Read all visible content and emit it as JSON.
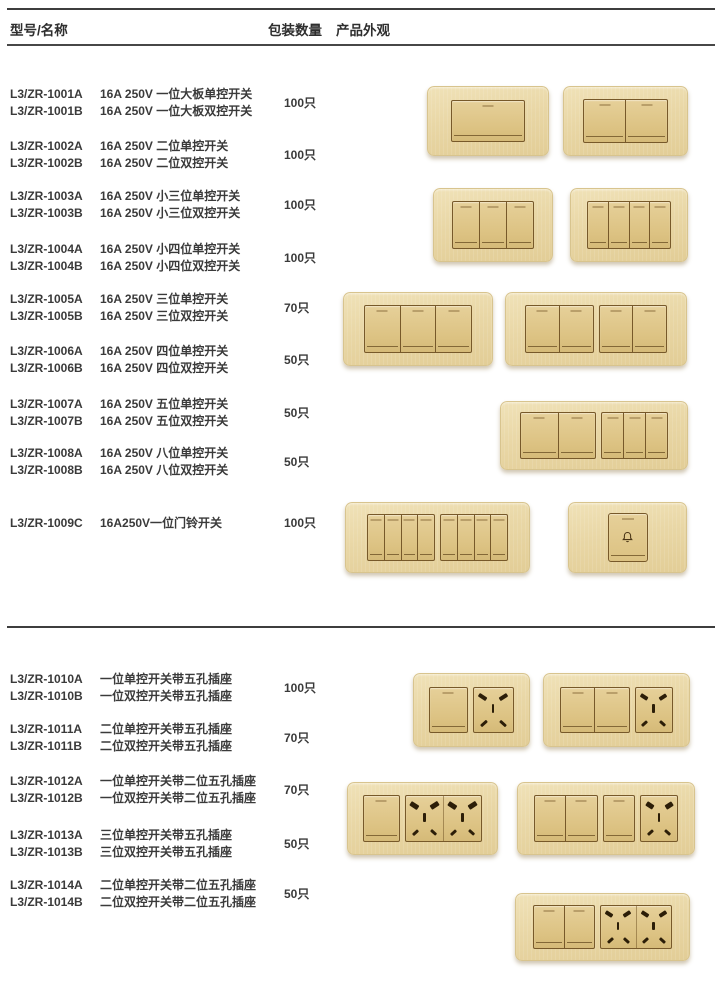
{
  "header": {
    "col_model": "型号/名称",
    "col_qty": "包装数量",
    "col_appearance": "产品外观"
  },
  "table": {
    "rows": [
      {
        "entries": [
          {
            "model": "L3/ZR-1001A",
            "desc": "16A 250V 一位大板单控开关"
          },
          {
            "model": "L3/ZR-1001B",
            "desc": "16A 250V 一位大板双控开关"
          }
        ],
        "qty": "100只"
      },
      {
        "entries": [
          {
            "model": "L3/ZR-1002A",
            "desc": "16A 250V 二位单控开关"
          },
          {
            "model": "L3/ZR-1002B",
            "desc": "16A 250V 二位双控开关"
          }
        ],
        "qty": "100只"
      },
      {
        "entries": [
          {
            "model": "L3/ZR-1003A",
            "desc": "16A 250V 小三位单控开关"
          },
          {
            "model": "L3/ZR-1003B",
            "desc": "16A 250V 小三位双控开关"
          }
        ],
        "qty": "100只"
      },
      {
        "entries": [
          {
            "model": "L3/ZR-1004A",
            "desc": "16A 250V 小四位单控开关"
          },
          {
            "model": "L3/ZR-1004B",
            "desc": "16A 250V 小四位双控开关"
          }
        ],
        "qty": "100只"
      },
      {
        "entries": [
          {
            "model": "L3/ZR-1005A",
            "desc": "16A 250V 三位单控开关"
          },
          {
            "model": "L3/ZR-1005B",
            "desc": "16A 250V 三位双控开关"
          }
        ],
        "qty": "70只"
      },
      {
        "entries": [
          {
            "model": "L3/ZR-1006A",
            "desc": "16A 250V 四位单控开关"
          },
          {
            "model": "L3/ZR-1006B",
            "desc": "16A 250V 四位双控开关"
          }
        ],
        "qty": "50只"
      },
      {
        "entries": [
          {
            "model": "L3/ZR-1007A",
            "desc": "16A 250V 五位单控开关"
          },
          {
            "model": "L3/ZR-1007B",
            "desc": "16A 250V 五位双控开关"
          }
        ],
        "qty": "50只"
      },
      {
        "entries": [
          {
            "model": "L3/ZR-1008A",
            "desc": "16A 250V 八位单控开关"
          },
          {
            "model": "L3/ZR-1008B",
            "desc": "16A 250V 八位双控开关"
          }
        ],
        "qty": "50只"
      },
      {
        "entries": [
          {
            "model": "L3/ZR-1009C",
            "desc": "16A250V一位门铃开关"
          }
        ],
        "qty": "100只"
      },
      {
        "entries": [
          {
            "model": "L3/ZR-1010A",
            "desc": "一位单控开关带五孔插座"
          },
          {
            "model": "L3/ZR-1010B",
            "desc": "一位双控开关带五孔插座"
          }
        ],
        "qty": "100只"
      },
      {
        "entries": [
          {
            "model": "L3/ZR-1011A",
            "desc": "二位单控开关带五孔插座"
          },
          {
            "model": "L3/ZR-1011B",
            "desc": "二位双控开关带五孔插座"
          }
        ],
        "qty": "70只"
      },
      {
        "entries": [
          {
            "model": "L3/ZR-1012A",
            "desc": "一位单控开关带二位五孔插座"
          },
          {
            "model": "L3/ZR-1012B",
            "desc": "一位双控开关带二位五孔插座"
          }
        ],
        "qty": "70只"
      },
      {
        "entries": [
          {
            "model": "L3/ZR-1013A",
            "desc": "三位单控开关带五孔插座"
          },
          {
            "model": "L3/ZR-1013B",
            "desc": "三位双控开关带五孔插座"
          }
        ],
        "qty": "50只"
      },
      {
        "entries": [
          {
            "model": "L3/ZR-1014A",
            "desc": "二位单控开关带二位五孔插座"
          },
          {
            "model": "L3/ZR-1014B",
            "desc": "二位双控开关带二位五孔插座"
          }
        ],
        "qty": "50只"
      }
    ]
  },
  "plates": [
    {
      "id": "1001",
      "label": "one-gang-large-switch",
      "modules": [
        {
          "kind": "rockers",
          "n": 1
        }
      ]
    },
    {
      "id": "1002",
      "label": "two-gang-switch",
      "modules": [
        {
          "kind": "rockers",
          "n": 2
        }
      ]
    },
    {
      "id": "1003",
      "label": "small-three-gang-switch",
      "modules": [
        {
          "kind": "rockers",
          "n": 3
        }
      ]
    },
    {
      "id": "1004",
      "label": "small-four-gang-switch",
      "modules": [
        {
          "kind": "rockers",
          "n": 4
        }
      ]
    },
    {
      "id": "1005",
      "label": "three-gang-switch-wide",
      "modules": [
        {
          "kind": "rockers",
          "n": 3
        }
      ]
    },
    {
      "id": "1006",
      "label": "four-gang-switch-wide",
      "modules": [
        {
          "kind": "rockers",
          "n": 2
        },
        {
          "kind": "rockers",
          "n": 2
        }
      ]
    },
    {
      "id": "1007",
      "label": "five-gang-switch",
      "modules": [
        {
          "kind": "rockers",
          "n": 2
        },
        {
          "kind": "rockers",
          "n": 3
        }
      ]
    },
    {
      "id": "1008",
      "label": "eight-gang-switch",
      "modules": [
        {
          "kind": "rockers",
          "n": 4
        },
        {
          "kind": "rockers",
          "n": 4
        }
      ]
    },
    {
      "id": "1009",
      "label": "doorbell-switch",
      "modules": [
        {
          "kind": "doorbell"
        }
      ]
    },
    {
      "id": "1010",
      "label": "one-switch-with-5hole-socket",
      "modules": [
        {
          "kind": "rockers",
          "n": 1
        },
        {
          "kind": "socket"
        }
      ]
    },
    {
      "id": "1011",
      "label": "two-switch-with-5hole-socket",
      "modules": [
        {
          "kind": "rockers",
          "n": 2
        },
        {
          "kind": "socket"
        }
      ]
    },
    {
      "id": "1012",
      "label": "one-switch-with-double-5hole-socket",
      "modules": [
        {
          "kind": "rockers",
          "n": 1
        },
        {
          "kind": "socket2"
        }
      ]
    },
    {
      "id": "1013",
      "label": "three-switch-with-5hole-socket",
      "modules": [
        {
          "kind": "rockers",
          "n": 2
        },
        {
          "kind": "rockers",
          "n": 1
        },
        {
          "kind": "socket"
        }
      ]
    },
    {
      "id": "1014",
      "label": "two-switch-with-double-5hole-socket",
      "modules": [
        {
          "kind": "rockers",
          "n": 2
        },
        {
          "kind": "socket2"
        }
      ]
    }
  ],
  "icons": {
    "doorbell": "bell-icon"
  },
  "colors": {
    "plate_gold": "#e9d7a6",
    "rocker_gold": "#dcc282",
    "border_bronze": "#77592a",
    "slot_dark": "#2c1e08",
    "text": "#3a3a3a",
    "rule": "#3d3d3d"
  }
}
